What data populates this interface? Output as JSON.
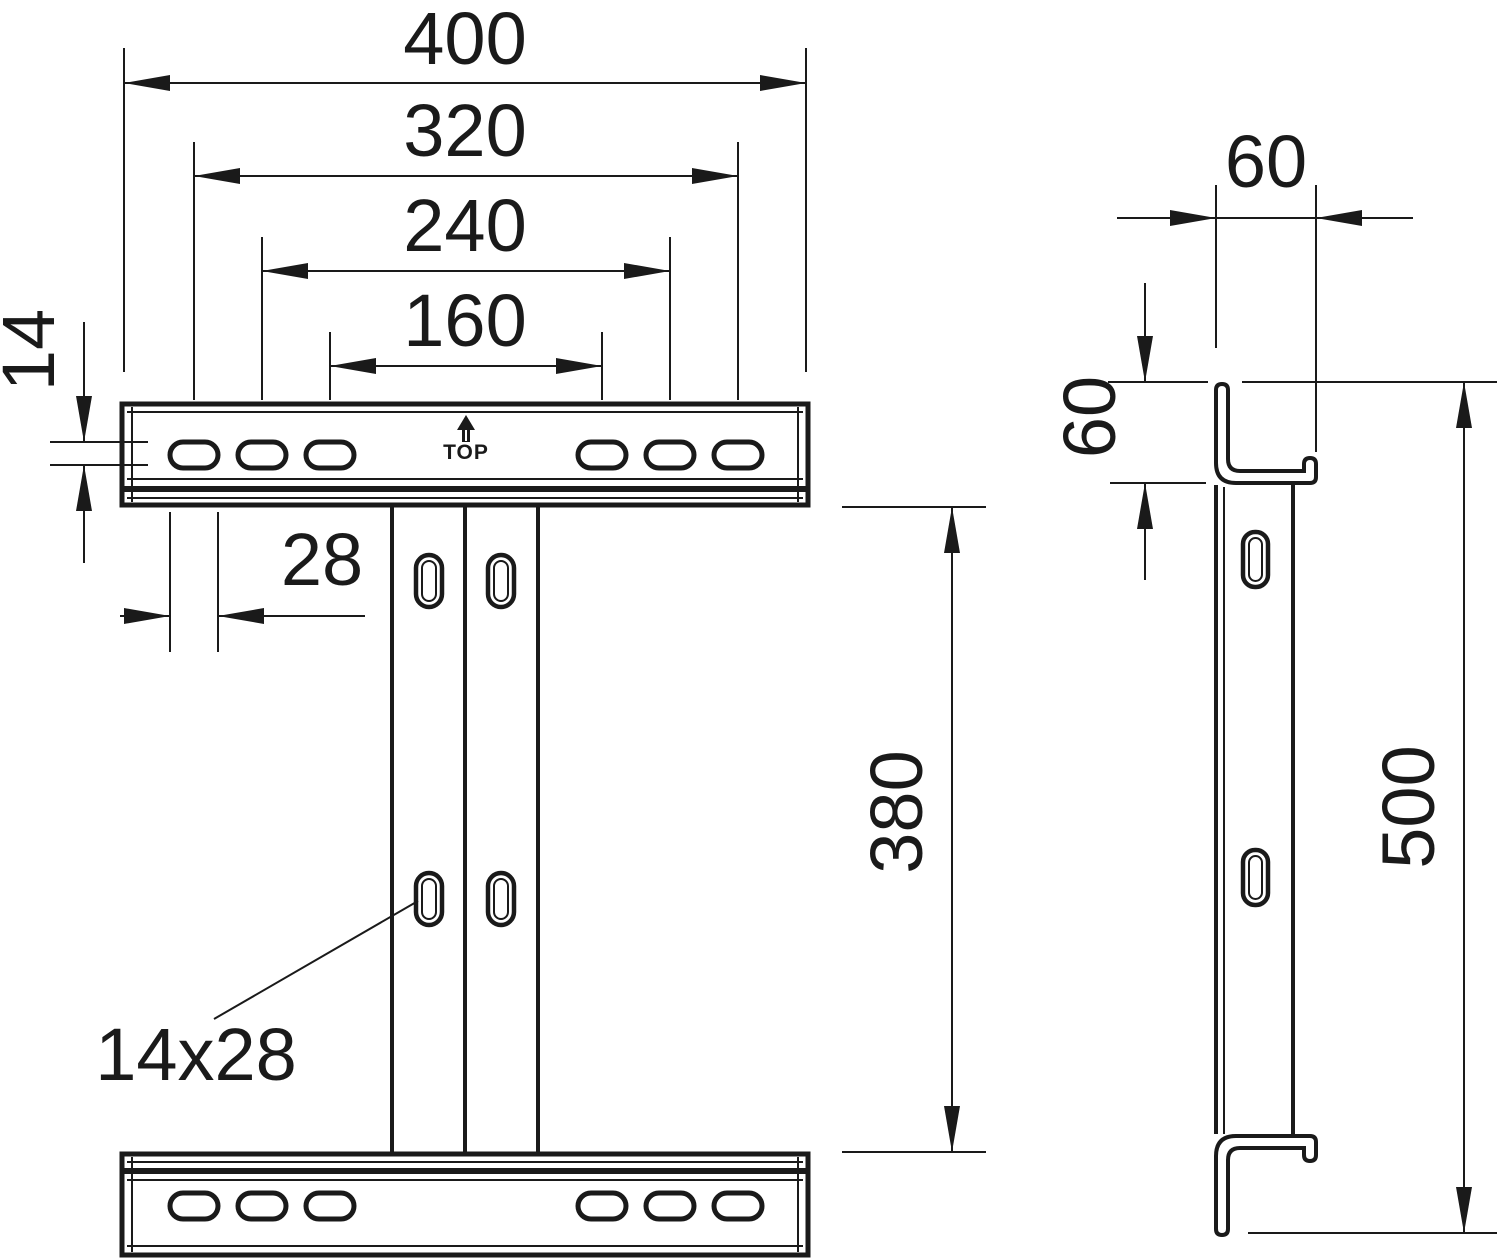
{
  "colors": {
    "line": "#1a1a1a",
    "background": "#ffffff"
  },
  "front_view": {
    "dim_width_overall": "400",
    "dim_slot_span_outer": "320",
    "dim_slot_span_mid": "240",
    "dim_slot_span_inner": "160",
    "dim_slot_height": "14",
    "dim_slot_length": "28",
    "dim_column_height": "380",
    "slot_size_label": "14x28",
    "orientation_marking": "TOP"
  },
  "side_view": {
    "dim_flange_depth": "60",
    "dim_rail_face_height": "60",
    "dim_total_height": "500"
  }
}
